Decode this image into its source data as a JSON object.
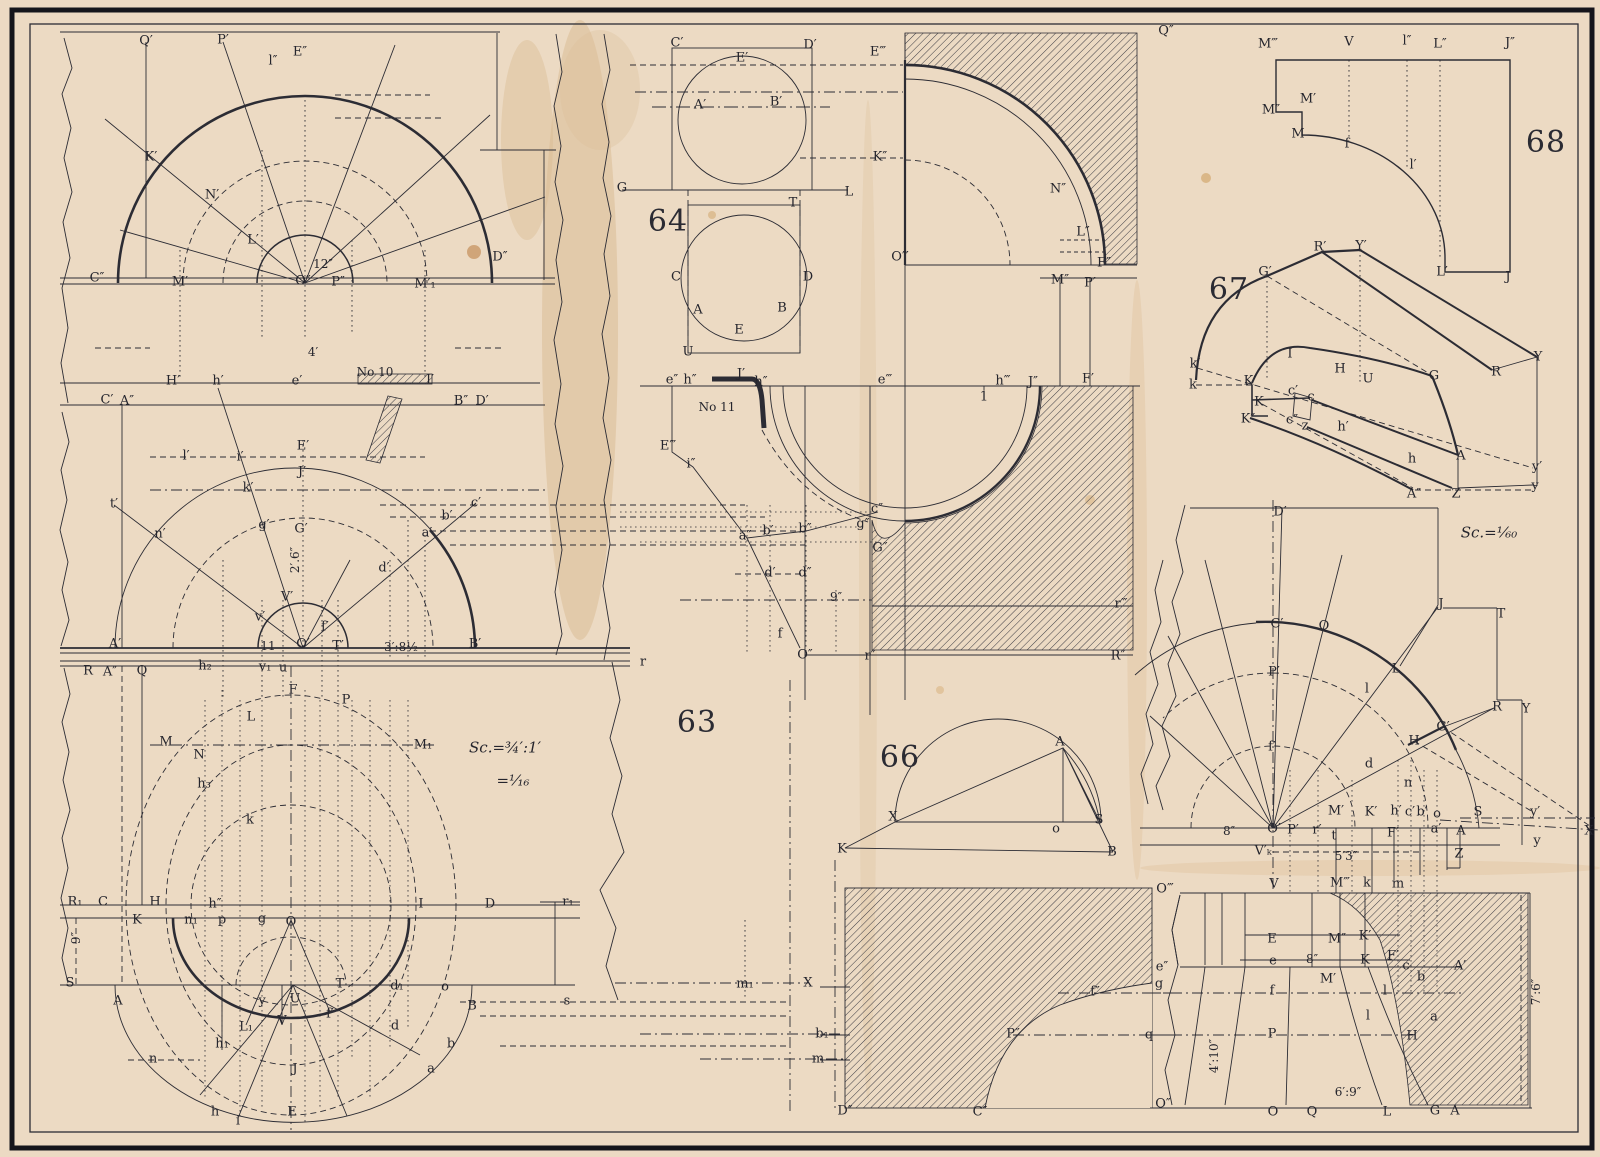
{
  "plate": {
    "figures": [
      "63",
      "64",
      "66",
      "67",
      "68"
    ],
    "ink_color": "#2c2c34",
    "paper_color": "#ecdac3",
    "hatch_color": "#3a3a42"
  },
  "labels": [
    {
      "t": "63",
      "x": 697,
      "y": 723,
      "c": "f"
    },
    {
      "t": "64",
      "x": 668,
      "y": 222,
      "c": "f"
    },
    {
      "t": "66",
      "x": 900,
      "y": 758,
      "c": "f"
    },
    {
      "t": "67",
      "x": 1229,
      "y": 290,
      "c": "f"
    },
    {
      "t": "68",
      "x": 1546,
      "y": 143,
      "c": "f"
    },
    {
      "t": "Sc.=¾′:1′",
      "x": 505,
      "y": 748,
      "c": "s"
    },
    {
      "t": "=¹⁄₁₆",
      "x": 513,
      "y": 781,
      "c": "s"
    },
    {
      "t": "Sc.=¹⁄₆₀",
      "x": 1489,
      "y": 533,
      "c": "s"
    },
    {
      "t": "12″",
      "x": 323,
      "y": 264,
      "c": "d"
    },
    {
      "t": "4′",
      "x": 313,
      "y": 352,
      "c": "d"
    },
    {
      "t": "2′.6″",
      "x": 295,
      "y": 560,
      "c": "d",
      "r": 1
    },
    {
      "t": "3′:8½",
      "x": 401,
      "y": 647,
      "c": "d"
    },
    {
      "t": "11",
      "x": 268,
      "y": 646,
      "c": "d"
    },
    {
      "t": "9″",
      "x": 76,
      "y": 938,
      "c": "d",
      "r": 1
    },
    {
      "t": "9″",
      "x": 836,
      "y": 597,
      "c": "d"
    },
    {
      "t": "8″",
      "x": 1229,
      "y": 831,
      "c": "d"
    },
    {
      "t": "8″",
      "x": 1312,
      "y": 959,
      "c": "d"
    },
    {
      "t": "5′3″",
      "x": 1346,
      "y": 856,
      "c": "d"
    },
    {
      "t": "4′:10″",
      "x": 1214,
      "y": 1056,
      "c": "d",
      "r": 1
    },
    {
      "t": "6′:9″",
      "x": 1348,
      "y": 1092,
      "c": "d"
    },
    {
      "t": "7′:6″",
      "x": 1536,
      "y": 992,
      "c": "d",
      "r": 1
    },
    {
      "t": "No 10",
      "x": 375,
      "y": 372,
      "c": "d"
    },
    {
      "t": "No 11",
      "x": 717,
      "y": 407,
      "c": "d"
    },
    {
      "t": "Q′",
      "x": 146,
      "y": 41
    },
    {
      "t": "P′",
      "x": 223,
      "y": 40
    },
    {
      "t": "l″",
      "x": 273,
      "y": 61
    },
    {
      "t": "E″",
      "x": 300,
      "y": 52
    },
    {
      "t": "K′",
      "x": 151,
      "y": 157
    },
    {
      "t": "N′",
      "x": 212,
      "y": 195
    },
    {
      "t": "L′",
      "x": 253,
      "y": 240
    },
    {
      "t": "C″",
      "x": 97,
      "y": 278
    },
    {
      "t": "M′",
      "x": 180,
      "y": 282
    },
    {
      "t": "O″",
      "x": 303,
      "y": 281
    },
    {
      "t": "P″",
      "x": 338,
      "y": 282
    },
    {
      "t": "M′₁",
      "x": 425,
      "y": 284
    },
    {
      "t": "D″",
      "x": 500,
      "y": 257
    },
    {
      "t": "H′",
      "x": 173,
      "y": 381
    },
    {
      "t": "h′",
      "x": 218,
      "y": 381
    },
    {
      "t": "e′",
      "x": 297,
      "y": 381
    },
    {
      "t": "I′",
      "x": 430,
      "y": 380
    },
    {
      "t": "C′",
      "x": 107,
      "y": 400
    },
    {
      "t": "A″",
      "x": 127,
      "y": 401
    },
    {
      "t": "B″",
      "x": 461,
      "y": 401
    },
    {
      "t": "D′",
      "x": 482,
      "y": 401
    },
    {
      "t": "l′",
      "x": 186,
      "y": 456
    },
    {
      "t": "i′",
      "x": 240,
      "y": 457
    },
    {
      "t": "E′",
      "x": 303,
      "y": 446
    },
    {
      "t": "J′",
      "x": 302,
      "y": 472
    },
    {
      "t": "k′",
      "x": 248,
      "y": 488
    },
    {
      "t": "t′",
      "x": 114,
      "y": 504
    },
    {
      "t": "n′",
      "x": 160,
      "y": 534
    },
    {
      "t": "g′",
      "x": 264,
      "y": 525
    },
    {
      "t": "G′",
      "x": 301,
      "y": 529
    },
    {
      "t": "c′",
      "x": 476,
      "y": 503
    },
    {
      "t": "b′",
      "x": 447,
      "y": 516
    },
    {
      "t": "a′",
      "x": 427,
      "y": 533
    },
    {
      "t": "d′",
      "x": 384,
      "y": 568
    },
    {
      "t": "V′",
      "x": 287,
      "y": 597
    },
    {
      "t": "v′",
      "x": 260,
      "y": 617
    },
    {
      "t": "f′",
      "x": 325,
      "y": 627
    },
    {
      "t": "A′",
      "x": 115,
      "y": 644
    },
    {
      "t": "O′",
      "x": 303,
      "y": 644
    },
    {
      "t": "T′",
      "x": 338,
      "y": 646
    },
    {
      "t": "B′",
      "x": 475,
      "y": 644
    },
    {
      "t": "r",
      "x": 643,
      "y": 662
    },
    {
      "t": "R",
      "x": 88,
      "y": 671
    },
    {
      "t": "A″",
      "x": 110,
      "y": 672
    },
    {
      "t": "Q",
      "x": 142,
      "y": 671
    },
    {
      "t": "h₂",
      "x": 205,
      "y": 666
    },
    {
      "t": "v₁",
      "x": 265,
      "y": 667
    },
    {
      "t": "u",
      "x": 283,
      "y": 668
    },
    {
      "t": "F",
      "x": 293,
      "y": 690
    },
    {
      "t": "P",
      "x": 346,
      "y": 700
    },
    {
      "t": "L",
      "x": 251,
      "y": 717
    },
    {
      "t": "M",
      "x": 166,
      "y": 742
    },
    {
      "t": "N",
      "x": 199,
      "y": 755
    },
    {
      "t": "M₁",
      "x": 423,
      "y": 745
    },
    {
      "t": "h₃",
      "x": 204,
      "y": 784
    },
    {
      "t": "k",
      "x": 250,
      "y": 820
    },
    {
      "t": "R₁",
      "x": 75,
      "y": 902
    },
    {
      "t": "C",
      "x": 103,
      "y": 902
    },
    {
      "t": "H",
      "x": 155,
      "y": 902
    },
    {
      "t": "h″",
      "x": 215,
      "y": 904
    },
    {
      "t": "I",
      "x": 421,
      "y": 904
    },
    {
      "t": "D",
      "x": 490,
      "y": 904
    },
    {
      "t": "r₁",
      "x": 568,
      "y": 902
    },
    {
      "t": "K",
      "x": 137,
      "y": 920
    },
    {
      "t": "n₁",
      "x": 191,
      "y": 920
    },
    {
      "t": "p",
      "x": 222,
      "y": 920
    },
    {
      "t": "g",
      "x": 262,
      "y": 919
    },
    {
      "t": "O",
      "x": 291,
      "y": 922
    },
    {
      "t": "S",
      "x": 70,
      "y": 983
    },
    {
      "t": "A",
      "x": 118,
      "y": 1001
    },
    {
      "t": "y",
      "x": 262,
      "y": 1001
    },
    {
      "t": "U",
      "x": 295,
      "y": 999
    },
    {
      "t": "T",
      "x": 340,
      "y": 984
    },
    {
      "t": "d₁",
      "x": 397,
      "y": 986
    },
    {
      "t": "o",
      "x": 445,
      "y": 987
    },
    {
      "t": "B",
      "x": 472,
      "y": 1006
    },
    {
      "t": "s",
      "x": 567,
      "y": 1001
    },
    {
      "t": "f′",
      "x": 330,
      "y": 1014
    },
    {
      "t": "V",
      "x": 282,
      "y": 1021
    },
    {
      "t": "L₁",
      "x": 246,
      "y": 1027
    },
    {
      "t": "h₁",
      "x": 222,
      "y": 1044
    },
    {
      "t": "d",
      "x": 395,
      "y": 1026
    },
    {
      "t": "b",
      "x": 451,
      "y": 1044
    },
    {
      "t": "a",
      "x": 431,
      "y": 1069
    },
    {
      "t": "n",
      "x": 153,
      "y": 1059
    },
    {
      "t": "J",
      "x": 295,
      "y": 1069
    },
    {
      "t": "h",
      "x": 215,
      "y": 1112
    },
    {
      "t": "i",
      "x": 238,
      "y": 1121
    },
    {
      "t": "E",
      "x": 292,
      "y": 1112
    },
    {
      "t": "m₁",
      "x": 745,
      "y": 984
    },
    {
      "t": "X",
      "x": 808,
      "y": 983
    },
    {
      "t": "b₁",
      "x": 822,
      "y": 1034
    },
    {
      "t": "m",
      "x": 818,
      "y": 1059
    },
    {
      "t": "C′",
      "x": 677,
      "y": 43
    },
    {
      "t": "D′",
      "x": 810,
      "y": 45
    },
    {
      "t": "E′",
      "x": 742,
      "y": 58
    },
    {
      "t": "A′",
      "x": 700,
      "y": 105
    },
    {
      "t": "B′",
      "x": 776,
      "y": 102
    },
    {
      "t": "G",
      "x": 622,
      "y": 188
    },
    {
      "t": "L",
      "x": 849,
      "y": 192
    },
    {
      "t": "T",
      "x": 793,
      "y": 203
    },
    {
      "t": "C",
      "x": 676,
      "y": 277
    },
    {
      "t": "D",
      "x": 808,
      "y": 277
    },
    {
      "t": "A",
      "x": 698,
      "y": 310
    },
    {
      "t": "B",
      "x": 782,
      "y": 308
    },
    {
      "t": "E",
      "x": 739,
      "y": 330
    },
    {
      "t": "U",
      "x": 688,
      "y": 352
    },
    {
      "t": "E‴",
      "x": 878,
      "y": 52
    },
    {
      "t": "Q″",
      "x": 1166,
      "y": 31
    },
    {
      "t": "K″",
      "x": 880,
      "y": 157
    },
    {
      "t": "N″",
      "x": 1058,
      "y": 189
    },
    {
      "t": "L″",
      "x": 1083,
      "y": 232
    },
    {
      "t": "F″",
      "x": 1104,
      "y": 263
    },
    {
      "t": "M″",
      "x": 1060,
      "y": 280
    },
    {
      "t": "P′",
      "x": 1090,
      "y": 283
    },
    {
      "t": "O‴",
      "x": 900,
      "y": 257
    },
    {
      "t": "e″",
      "x": 672,
      "y": 380
    },
    {
      "t": "h″",
      "x": 690,
      "y": 380
    },
    {
      "t": "J′",
      "x": 741,
      "y": 374
    },
    {
      "t": "h″",
      "x": 761,
      "y": 382
    },
    {
      "t": "e‴",
      "x": 885,
      "y": 380
    },
    {
      "t": "h‴",
      "x": 1003,
      "y": 381
    },
    {
      "t": "J″",
      "x": 1033,
      "y": 382
    },
    {
      "t": "1",
      "x": 984,
      "y": 397
    },
    {
      "t": "F′",
      "x": 1088,
      "y": 379
    },
    {
      "t": "E‴",
      "x": 668,
      "y": 446
    },
    {
      "t": "i″",
      "x": 691,
      "y": 464
    },
    {
      "t": "a″",
      "x": 745,
      "y": 536
    },
    {
      "t": "b′",
      "x": 768,
      "y": 531
    },
    {
      "t": "b″",
      "x": 805,
      "y": 529
    },
    {
      "t": "c″",
      "x": 877,
      "y": 509
    },
    {
      "t": "g″",
      "x": 863,
      "y": 524
    },
    {
      "t": "G″",
      "x": 880,
      "y": 548
    },
    {
      "t": "d′",
      "x": 770,
      "y": 573
    },
    {
      "t": "d″",
      "x": 805,
      "y": 573
    },
    {
      "t": "f",
      "x": 780,
      "y": 634
    },
    {
      "t": "O″",
      "x": 805,
      "y": 655
    },
    {
      "t": "r″",
      "x": 870,
      "y": 656
    },
    {
      "t": "r‴",
      "x": 1121,
      "y": 604
    },
    {
      "t": "R″",
      "x": 1118,
      "y": 656
    },
    {
      "t": "M‴",
      "x": 1268,
      "y": 44
    },
    {
      "t": "V",
      "x": 1349,
      "y": 42
    },
    {
      "t": "l″",
      "x": 1407,
      "y": 41
    },
    {
      "t": "L″",
      "x": 1440,
      "y": 44
    },
    {
      "t": "J″",
      "x": 1510,
      "y": 43
    },
    {
      "t": "M′",
      "x": 1308,
      "y": 99
    },
    {
      "t": "M″",
      "x": 1271,
      "y": 110
    },
    {
      "t": "M",
      "x": 1298,
      "y": 134
    },
    {
      "t": "f",
      "x": 1347,
      "y": 144
    },
    {
      "t": "l′",
      "x": 1413,
      "y": 165
    },
    {
      "t": "L′",
      "x": 1442,
      "y": 272
    },
    {
      "t": "J",
      "x": 1508,
      "y": 277
    },
    {
      "t": "R′",
      "x": 1320,
      "y": 247
    },
    {
      "t": "Y′",
      "x": 1361,
      "y": 246
    },
    {
      "t": "G′",
      "x": 1265,
      "y": 272
    },
    {
      "t": "k′",
      "x": 1195,
      "y": 364
    },
    {
      "t": "k",
      "x": 1193,
      "y": 385
    },
    {
      "t": "K′",
      "x": 1250,
      "y": 381
    },
    {
      "t": "K",
      "x": 1259,
      "y": 402
    },
    {
      "t": "K″",
      "x": 1248,
      "y": 419
    },
    {
      "t": "c′",
      "x": 1293,
      "y": 391
    },
    {
      "t": "c",
      "x": 1311,
      "y": 397
    },
    {
      "t": "c″",
      "x": 1292,
      "y": 420
    },
    {
      "t": "z",
      "x": 1305,
      "y": 426
    },
    {
      "t": "I",
      "x": 1290,
      "y": 354
    },
    {
      "t": "H",
      "x": 1340,
      "y": 369
    },
    {
      "t": "U",
      "x": 1368,
      "y": 379
    },
    {
      "t": "G",
      "x": 1434,
      "y": 376
    },
    {
      "t": "R",
      "x": 1496,
      "y": 372
    },
    {
      "t": "Y",
      "x": 1538,
      "y": 357
    },
    {
      "t": "h′",
      "x": 1343,
      "y": 427
    },
    {
      "t": "h",
      "x": 1412,
      "y": 459
    },
    {
      "t": "A",
      "x": 1461,
      "y": 456
    },
    {
      "t": "y′",
      "x": 1537,
      "y": 467
    },
    {
      "t": "y",
      "x": 1535,
      "y": 486
    },
    {
      "t": "A″",
      "x": 1414,
      "y": 494
    },
    {
      "t": "Z",
      "x": 1456,
      "y": 494
    },
    {
      "t": "D′",
      "x": 1280,
      "y": 512
    },
    {
      "t": "J",
      "x": 1441,
      "y": 604
    },
    {
      "t": "T",
      "x": 1501,
      "y": 614
    },
    {
      "t": "C′",
      "x": 1277,
      "y": 624
    },
    {
      "t": "Q",
      "x": 1324,
      "y": 626
    },
    {
      "t": "P′",
      "x": 1274,
      "y": 672
    },
    {
      "t": "L",
      "x": 1396,
      "y": 669
    },
    {
      "t": "l",
      "x": 1367,
      "y": 689
    },
    {
      "t": "R",
      "x": 1497,
      "y": 707
    },
    {
      "t": "Y",
      "x": 1526,
      "y": 709
    },
    {
      "t": "G′",
      "x": 1443,
      "y": 727
    },
    {
      "t": "H",
      "x": 1414,
      "y": 741
    },
    {
      "t": "f′",
      "x": 1272,
      "y": 747
    },
    {
      "t": "d",
      "x": 1369,
      "y": 764
    },
    {
      "t": "n",
      "x": 1408,
      "y": 783
    },
    {
      "t": "M′",
      "x": 1336,
      "y": 811
    },
    {
      "t": "K′",
      "x": 1371,
      "y": 812
    },
    {
      "t": "h′",
      "x": 1396,
      "y": 811
    },
    {
      "t": "c′",
      "x": 1410,
      "y": 812
    },
    {
      "t": "b′",
      "x": 1422,
      "y": 812
    },
    {
      "t": "o",
      "x": 1437,
      "y": 814
    },
    {
      "t": "S",
      "x": 1478,
      "y": 812
    },
    {
      "t": "y′",
      "x": 1535,
      "y": 812
    },
    {
      "t": "X",
      "x": 1589,
      "y": 831
    },
    {
      "t": "y",
      "x": 1537,
      "y": 841
    },
    {
      "t": "O′",
      "x": 1274,
      "y": 829
    },
    {
      "t": "P′",
      "x": 1293,
      "y": 830
    },
    {
      "t": "r′",
      "x": 1317,
      "y": 830
    },
    {
      "t": "t",
      "x": 1334,
      "y": 836
    },
    {
      "t": "F′",
      "x": 1393,
      "y": 833
    },
    {
      "t": "a′",
      "x": 1436,
      "y": 829
    },
    {
      "t": "A",
      "x": 1461,
      "y": 831
    },
    {
      "t": "Z",
      "x": 1459,
      "y": 854
    },
    {
      "t": "V′ₖ",
      "x": 1263,
      "y": 851
    },
    {
      "t": "O‴",
      "x": 1165,
      "y": 889
    },
    {
      "t": "V",
      "x": 1274,
      "y": 884
    },
    {
      "t": "M‴",
      "x": 1340,
      "y": 883
    },
    {
      "t": "k",
      "x": 1367,
      "y": 883
    },
    {
      "t": "m",
      "x": 1398,
      "y": 884
    },
    {
      "t": "E",
      "x": 1272,
      "y": 939
    },
    {
      "t": "M″",
      "x": 1337,
      "y": 939
    },
    {
      "t": "K′",
      "x": 1365,
      "y": 936
    },
    {
      "t": "e",
      "x": 1273,
      "y": 961
    },
    {
      "t": "K",
      "x": 1365,
      "y": 960
    },
    {
      "t": "F′",
      "x": 1393,
      "y": 956
    },
    {
      "t": "c",
      "x": 1406,
      "y": 966
    },
    {
      "t": "A′",
      "x": 1460,
      "y": 966
    },
    {
      "t": "e″",
      "x": 1162,
      "y": 967
    },
    {
      "t": "g",
      "x": 1159,
      "y": 984
    },
    {
      "t": "M′",
      "x": 1328,
      "y": 979
    },
    {
      "t": "f",
      "x": 1272,
      "y": 991
    },
    {
      "t": "l",
      "x": 1385,
      "y": 991
    },
    {
      "t": "b",
      "x": 1421,
      "y": 977
    },
    {
      "t": "l",
      "x": 1368,
      "y": 1016
    },
    {
      "t": "P",
      "x": 1272,
      "y": 1034
    },
    {
      "t": "H",
      "x": 1412,
      "y": 1036
    },
    {
      "t": "a",
      "x": 1434,
      "y": 1017
    },
    {
      "t": "q",
      "x": 1149,
      "y": 1035
    },
    {
      "t": "O″",
      "x": 1163,
      "y": 1104
    },
    {
      "t": "O",
      "x": 1273,
      "y": 1112
    },
    {
      "t": "Q",
      "x": 1312,
      "y": 1112
    },
    {
      "t": "L",
      "x": 1387,
      "y": 1112
    },
    {
      "t": "G",
      "x": 1435,
      "y": 1111
    },
    {
      "t": "A",
      "x": 1455,
      "y": 1111
    },
    {
      "t": "K",
      "x": 842,
      "y": 849
    },
    {
      "t": "B",
      "x": 1112,
      "y": 852
    },
    {
      "t": "D″",
      "x": 845,
      "y": 1111
    },
    {
      "t": "C″",
      "x": 980,
      "y": 1112
    },
    {
      "t": "P″",
      "x": 1013,
      "y": 1034
    },
    {
      "t": "f″",
      "x": 1095,
      "y": 992
    },
    {
      "t": "A",
      "x": 1060,
      "y": 742
    },
    {
      "t": "X",
      "x": 893,
      "y": 817
    },
    {
      "t": "o",
      "x": 1056,
      "y": 829
    },
    {
      "t": "S",
      "x": 1099,
      "y": 820
    }
  ]
}
